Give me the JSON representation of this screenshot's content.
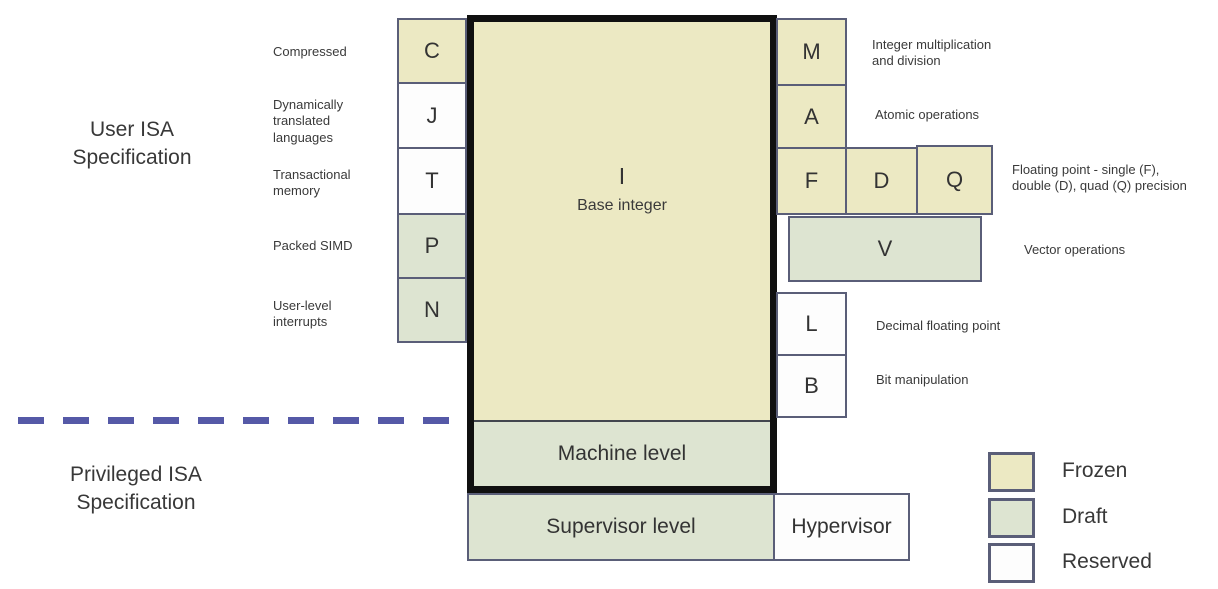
{
  "titles": {
    "user": "User ISA\nSpecification",
    "privileged": "Privileged ISA\nSpecification"
  },
  "base": {
    "letter": "I",
    "label": "Base integer",
    "status": "frozen"
  },
  "left_extensions": [
    {
      "letter": "C",
      "label": "Compressed",
      "status": "frozen"
    },
    {
      "letter": "J",
      "label": "Dynamically\ntranslated\nlanguages",
      "status": "reserved"
    },
    {
      "letter": "T",
      "label": "Transactional\nmemory",
      "status": "reserved"
    },
    {
      "letter": "P",
      "label": "Packed SIMD",
      "status": "draft"
    },
    {
      "letter": "N",
      "label": "User-level\ninterrupts",
      "status": "draft"
    }
  ],
  "right_extensions": {
    "m": {
      "letter": "M",
      "label": "Integer multiplication\nand division",
      "status": "frozen"
    },
    "a": {
      "letter": "A",
      "label": "Atomic operations",
      "status": "frozen"
    },
    "f": {
      "letter": "F",
      "status": "frozen"
    },
    "d": {
      "letter": "D",
      "status": "frozen"
    },
    "q": {
      "letter": "Q",
      "status": "frozen"
    },
    "fdq_label": "Floating point - single (F),\ndouble (D), quad (Q) precision",
    "v": {
      "letter": "V",
      "label": "Vector operations",
      "status": "draft"
    },
    "l": {
      "letter": "L",
      "label": "Decimal floating point",
      "status": "reserved"
    },
    "b": {
      "letter": "B",
      "label": "Bit manipulation",
      "status": "reserved"
    }
  },
  "privilege_levels": {
    "machine": "Machine level",
    "supervisor": "Supervisor level",
    "hypervisor": "Hypervisor"
  },
  "legend": {
    "items": [
      {
        "label": "Frozen",
        "color": "#ece9c3"
      },
      {
        "label": "Draft",
        "color": "#dde4d1"
      },
      {
        "label": "Reserved",
        "color": "#fdfdfd"
      }
    ]
  },
  "colors": {
    "frozen": "#ece9c3",
    "draft": "#dde4d1",
    "reserved": "#fdfdfd",
    "box_border": "#5a5e78",
    "outline": "#101010",
    "dashed_line": "#5559a7",
    "text": "#3a3a3a"
  }
}
